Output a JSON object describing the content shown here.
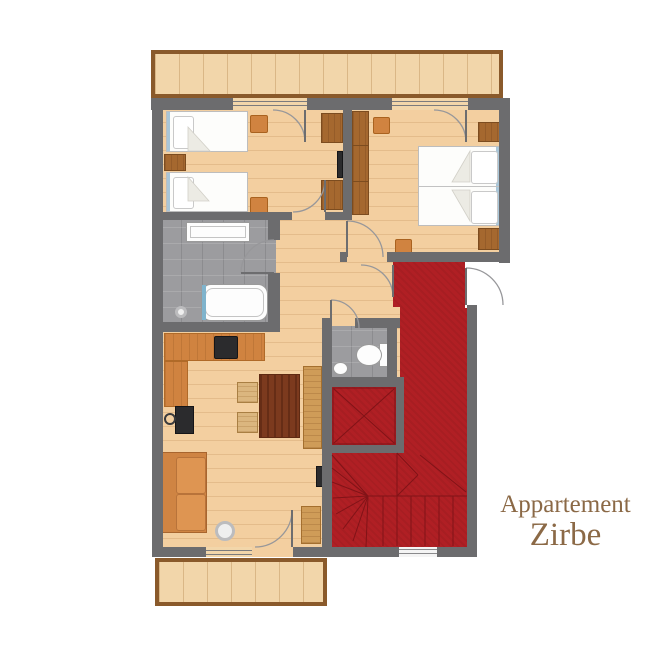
{
  "title": {
    "line1": "Appartement",
    "line2": "Zirbe"
  },
  "colors": {
    "wall": "#6c6c6e",
    "wood_floor": "#f3cfa0",
    "balcony_wood": "#f2d6aa",
    "balcony_border": "#8a5a2b",
    "tile": "#9c9c9f",
    "carpet": "#b01f24",
    "carpet_line": "#7c1216",
    "cabinet_wood": "#a5682f",
    "counter_orange": "#d08340",
    "table_wood": "#7c3a1e",
    "chair_wood": "#dbb67f",
    "sofa_orange": "#cf8443",
    "accent_blue": "#a9c6d8",
    "title_text": "#8b6946"
  },
  "plan": {
    "rooms": [
      {
        "id": "balcony-top"
      },
      {
        "id": "bedroom-1"
      },
      {
        "id": "bedroom-2"
      },
      {
        "id": "bathroom"
      },
      {
        "id": "hallway"
      },
      {
        "id": "wc"
      },
      {
        "id": "living-kitchen"
      },
      {
        "id": "entry-corridor"
      },
      {
        "id": "elevator-shaft"
      },
      {
        "id": "staircase"
      },
      {
        "id": "balcony-bottom"
      }
    ],
    "furniture": [
      {
        "id": "single-bed-1"
      },
      {
        "id": "single-bed-2"
      },
      {
        "id": "nightstand-1"
      },
      {
        "id": "stool-1"
      },
      {
        "id": "stool-2"
      },
      {
        "id": "wardrobe-1a"
      },
      {
        "id": "wardrobe-1b"
      },
      {
        "id": "wall-tv-bedroom1"
      },
      {
        "id": "wardrobe-2"
      },
      {
        "id": "stool-3"
      },
      {
        "id": "stool-4"
      },
      {
        "id": "double-bed"
      },
      {
        "id": "nightstand-2a"
      },
      {
        "id": "nightstand-2b"
      },
      {
        "id": "washbasin"
      },
      {
        "id": "bathtub"
      },
      {
        "id": "floor-drain"
      },
      {
        "id": "toilet"
      },
      {
        "id": "wc-basin"
      },
      {
        "id": "kitchen-counter"
      },
      {
        "id": "cooktop"
      },
      {
        "id": "stove-tv"
      },
      {
        "id": "dining-table"
      },
      {
        "id": "chair-1"
      },
      {
        "id": "chair-2"
      },
      {
        "id": "bench"
      },
      {
        "id": "sofa"
      },
      {
        "id": "floor-lamp"
      },
      {
        "id": "side-cabinet"
      },
      {
        "id": "wall-tv-living"
      }
    ]
  }
}
